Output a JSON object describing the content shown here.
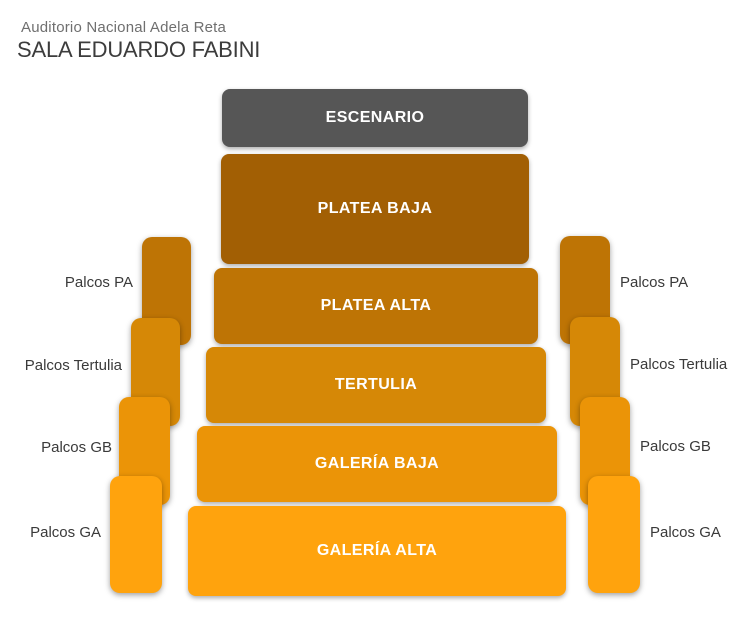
{
  "header": {
    "venue": "Auditorio Nacional Adela Reta",
    "hall": "SALA EDUARDO FABINI"
  },
  "stage": {
    "label": "ESCENARIO",
    "color": "#565656"
  },
  "sections": [
    {
      "id": "platea-baja",
      "label": "PLATEA BAJA",
      "color": "#A25F04"
    },
    {
      "id": "platea-alta",
      "label": "PLATEA ALTA",
      "color": "#BE7405"
    },
    {
      "id": "tertulia",
      "label": "TERTULIA",
      "color": "#D68806"
    },
    {
      "id": "galeria-baja",
      "label": "GALERÍA BAJA",
      "color": "#EB9407"
    },
    {
      "id": "galeria-alta",
      "label": "GALERÍA ALTA",
      "color": "#FFA30D"
    }
  ],
  "palcos": {
    "left": [
      {
        "label": "Palcos PA",
        "color": "#BE7405"
      },
      {
        "label": "Palcos Tertulia",
        "color": "#D68806"
      },
      {
        "label": "Palcos GB",
        "color": "#EB9407"
      },
      {
        "label": "Palcos GA",
        "color": "#FFA30D"
      }
    ],
    "right": [
      {
        "label": "Palcos PA",
        "color": "#BE7405"
      },
      {
        "label": "Palcos Tertulia",
        "color": "#D68806"
      },
      {
        "label": "Palcos GB",
        "color": "#EB9407"
      },
      {
        "label": "Palcos GA",
        "color": "#FFA30D"
      }
    ]
  },
  "colors": {
    "background": "#FFFFFF",
    "section_text": "#FFFFFF",
    "label_text": "#3A3A3A"
  }
}
